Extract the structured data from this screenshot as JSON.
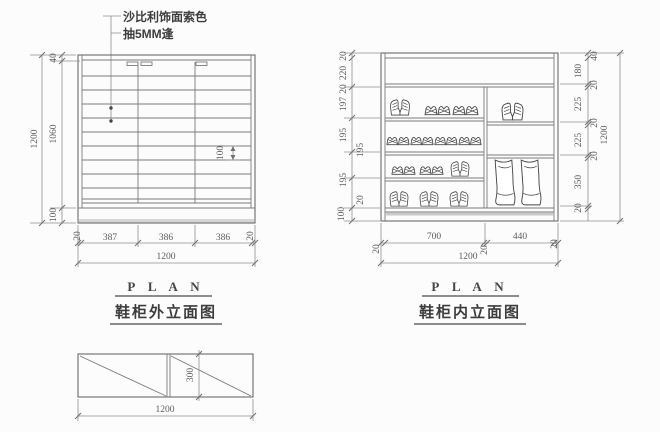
{
  "colors": {
    "line": "#6a6a6a",
    "dim_line": "#8f8f8f",
    "text": "#5c5c5c",
    "background": "#fcfcfc"
  },
  "annotation": {
    "line1": "沙比利饰面索色",
    "line2": "抽5MM逢"
  },
  "exterior": {
    "title_en": "P L A N",
    "title_zh": "鞋柜外立面图",
    "left_dims": {
      "top": "40",
      "middle": "1060",
      "bottom": "100",
      "total": "1200"
    },
    "slat_dim": "100",
    "bottom_dims": {
      "segments": [
        "20",
        "387",
        "386",
        "386",
        "20"
      ],
      "total": "1200"
    }
  },
  "interior": {
    "title_en": "P L A N",
    "title_zh": "鞋柜内立面图",
    "left_dims": [
      "20",
      "220",
      "20",
      "197",
      "195",
      "195",
      "195",
      "20",
      "100"
    ],
    "right_dims": [
      "40",
      "180",
      "20",
      "225",
      "20",
      "225",
      "20",
      "350",
      "20"
    ],
    "right_total": "1200",
    "bottom_dims": {
      "segments": [
        "20",
        "700",
        "20",
        "440",
        "20"
      ],
      "total": "1200"
    }
  },
  "plan": {
    "depth": "300",
    "width": "1200"
  }
}
